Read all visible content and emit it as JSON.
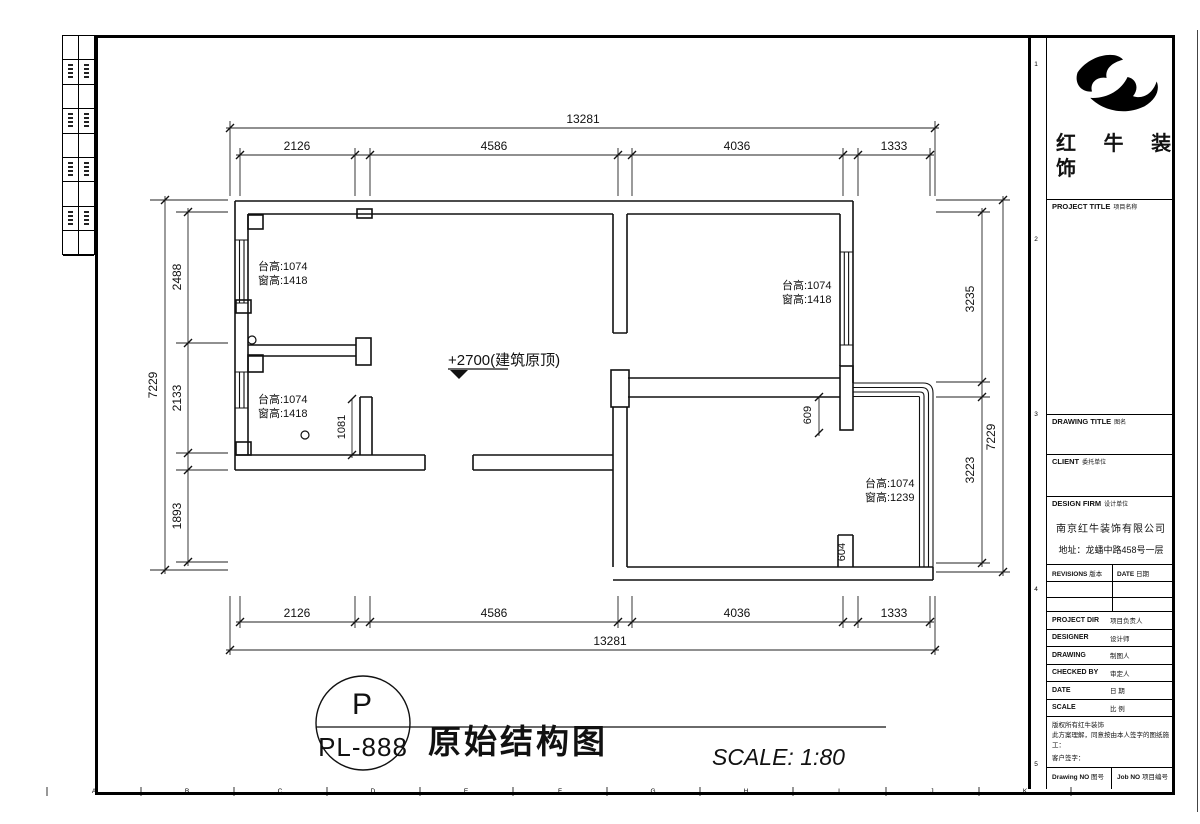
{
  "colors": {
    "line": "#111111",
    "background": "#ffffff"
  },
  "brand": {
    "line1": "红 牛 装",
    "line2": "饰"
  },
  "title_block": {
    "project_title": {
      "en": "PROJECT TITLE",
      "cn": "项目名称"
    },
    "drawing_title": {
      "en": "DRAWING TITLE",
      "cn": "图名"
    },
    "client": {
      "en": "CLIENT",
      "cn": "委托单位"
    },
    "design_firm": {
      "en": "DESIGN FIRM",
      "cn": "设计单位"
    },
    "firm_name": "南京红牛装饰有限公司",
    "firm_address": "地址：龙蟠中路458号一层",
    "revisions": {
      "en": "REVISIONS",
      "cn": "版本"
    },
    "date_col": {
      "en": "DATE",
      "cn": "日期"
    },
    "rows": [
      {
        "en": "PROJECT DIR",
        "cn": "项目负责人"
      },
      {
        "en": "DESIGNER",
        "cn": "设计师"
      },
      {
        "en": "DRAWING",
        "cn": "制图人"
      },
      {
        "en": "CHECKED BY",
        "cn": "审定人"
      },
      {
        "en": "DATE",
        "cn": "日 期"
      },
      {
        "en": "SCALE",
        "cn": "比 例"
      }
    ],
    "copyright": [
      "版权所有红牛装饰",
      "此方案理解，同意按由本人签字的图纸施工：",
      "客户签字："
    ],
    "drawing_no": {
      "en": "Drawing NO",
      "cn": "图号"
    },
    "job_no": {
      "en": "Job NO",
      "cn": "项目编号"
    }
  },
  "stamp": {
    "letter": "P",
    "code": "PL-888"
  },
  "footer": {
    "drawing_title": "原始结构图",
    "scale": "SCALE: 1:80"
  },
  "plan": {
    "elevation_note": "+2700(建筑原顶)",
    "room_notes": [
      {
        "line1": "台高:1074",
        "line2": "窗高:1418"
      },
      {
        "line1": "台高:1074",
        "line2": "窗高:1418"
      },
      {
        "line1": "台高:1074",
        "line2": "窗高:1418"
      },
      {
        "line1": "台高:1074",
        "line2": "窗高:1239"
      }
    ],
    "dims": {
      "top_total": "13281",
      "top_seg": [
        "2126",
        "4586",
        "4036",
        "1333"
      ],
      "bottom_seg": [
        "2126",
        "4586",
        "4036",
        "1333"
      ],
      "bottom_total": "13281",
      "left_total": "7229",
      "left_seg": [
        "2488",
        "2133",
        "1893"
      ],
      "right_seg": [
        "3235",
        "3223"
      ],
      "right_total": "7229",
      "stub_1081": "1081",
      "stub_609": "609",
      "stub_604": "604"
    }
  },
  "grid": {
    "bottom_letters": [
      "A",
      "B",
      "C",
      "D",
      "E",
      "F",
      "G",
      "H",
      "I",
      "J",
      "K"
    ],
    "right_numbers": [
      "1",
      "2",
      "3",
      "4",
      "5"
    ]
  }
}
